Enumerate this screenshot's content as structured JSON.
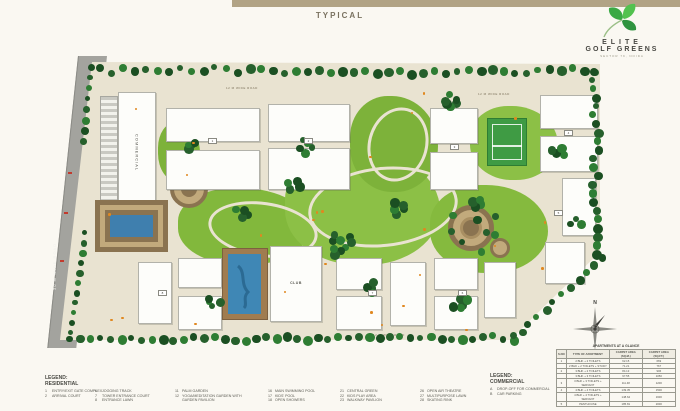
{
  "page": {
    "title_label": "TYPICAL"
  },
  "brand": {
    "line1": "ELITE",
    "line2": "GOLF GREENS",
    "tagline": "SECTOR 79, NOIDA",
    "leaf_color": "#3aa945"
  },
  "plan": {
    "road_label": "30 M WIDE ROAD",
    "internal_road_label": "12 M WIDE ROAD",
    "commercial_label": "COMMERCIAL",
    "club_label": "CLUB",
    "north_label": "N",
    "tower_numbers": [
      "1",
      "2",
      "3",
      "4",
      "5",
      "6",
      "7",
      "8"
    ],
    "colors": {
      "site_base": "#e9e3d1",
      "lawn_green": "#84b83c",
      "tree_green": "#26602c",
      "road_gray": "#a3a39e",
      "pool_blue": "#3f87b5",
      "deck_brown": "#a07c50",
      "accent_orange": "#e08820"
    }
  },
  "legend_residential": {
    "title": "LEGEND:",
    "subtitle": "RESIDENTIAL",
    "columns": [
      {
        "items": [
          {
            "num": "1",
            "text": "ENTRY/EXIT GATE COMPLEX"
          },
          {
            "num": "2",
            "text": "ARRIVAL COURT"
          }
        ]
      },
      {
        "items": [
          {
            "num": "6",
            "text": "JOGGING TRACK"
          },
          {
            "num": "7",
            "text": "TOWER ENTRANCE COURT"
          },
          {
            "num": "8",
            "text": "ENTRANCE LAWN"
          }
        ]
      },
      {
        "items": [
          {
            "num": "11",
            "text": "PALM GARDEN"
          },
          {
            "num": "12",
            "text": "YOGA/MEDITATION GARDEN WITH GARDEN PAVILION"
          }
        ]
      },
      {
        "items": [
          {
            "num": "16",
            "text": "MAIN SWIMMING POOL"
          },
          {
            "num": "17",
            "text": "KIDS' POOL"
          },
          {
            "num": "18",
            "text": "OPEN SHOWERS"
          }
        ]
      },
      {
        "items": [
          {
            "num": "21",
            "text": "CENTRAL GREEN"
          },
          {
            "num": "22",
            "text": "KIDS PLAY AREA"
          },
          {
            "num": "23",
            "text": "WALKWAY PAVILION"
          }
        ]
      },
      {
        "items": [
          {
            "num": "26",
            "text": "OPEN AIR THEATRE"
          },
          {
            "num": "27",
            "text": "MULTIPURPOSE LAWN"
          },
          {
            "num": "28",
            "text": "SKATING RINK"
          }
        ]
      }
    ]
  },
  "legend_commercial": {
    "title": "LEGEND:",
    "subtitle": "COMMERCIAL",
    "items": [
      {
        "num": "A",
        "text": "DROP-OFF FOR COMMERCIAL"
      },
      {
        "num": "B",
        "text": "CAR PARKING"
      }
    ]
  },
  "table": {
    "title": "APARTMENTS AT A GLANCE",
    "headers": [
      "S.NO",
      "TYPE OF APARTMENT",
      "CARPET AREA (SQ.M.)",
      "CARPET AREA (SQ.FT.)"
    ],
    "rows": [
      [
        "1",
        "2 BHK + 2 TOILETS",
        "62.15",
        "669"
      ],
      [
        "",
        "2 BHK + 2 TOILETS + STUDY",
        "71.21",
        "767"
      ],
      [
        "2",
        "3 BHK + 2 TOILETS",
        "84.13",
        "906"
      ],
      [
        "",
        "3 BHK + 3 TOILETS",
        "97.55",
        "1050"
      ],
      [
        "3",
        "3 BHK + 3 TOILETS + SERVANT",
        "111.48",
        "1200"
      ],
      [
        "4",
        "4 BHK + 4 TOILETS",
        "139.35",
        "1500"
      ],
      [
        "",
        "4 BHK + 4 TOILETS + SERVANT",
        "148.64",
        "1600"
      ],
      [
        "5",
        "PENTHOUSE",
        "185.81",
        "2000"
      ]
    ]
  }
}
